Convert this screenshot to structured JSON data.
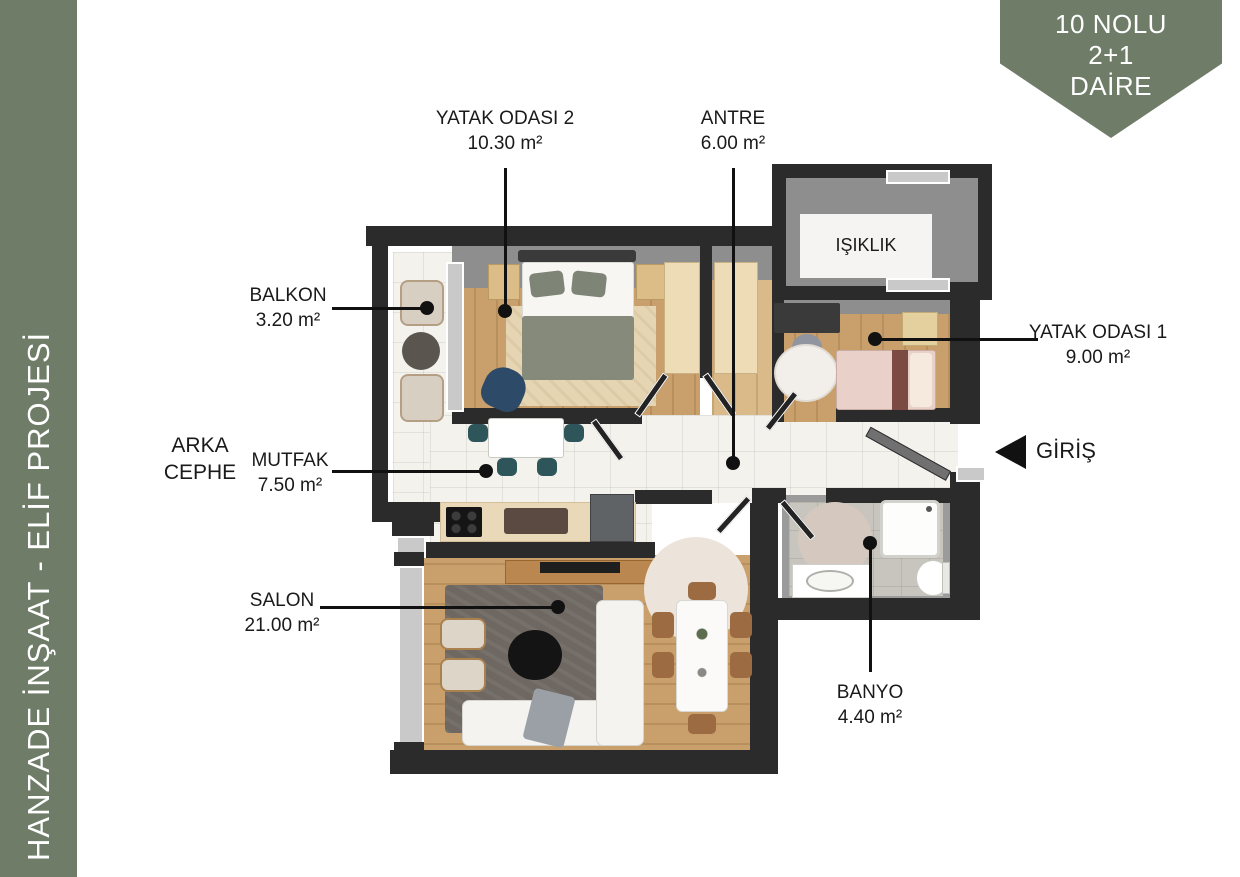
{
  "sidebar": {
    "text": "HANZADE İNŞAAT - ELİF PROJESİ"
  },
  "badge": {
    "line1": "10 NOLU",
    "line2": "2+1",
    "line3": "DAİRE"
  },
  "rooms": {
    "yatak_odasi_2": {
      "title": "YATAK ODASI 2",
      "area": "10.30 m²"
    },
    "antre": {
      "title": "ANTRE",
      "area": "6.00 m²"
    },
    "balkon": {
      "title": "BALKON",
      "area": "3.20 m²"
    },
    "mutfak": {
      "title": "MUTFAK",
      "area": "7.50 m²"
    },
    "salon": {
      "title": "SALON",
      "area": "21.00 m²"
    },
    "yatak_odasi_1": {
      "title": "YATAK ODASI 1",
      "area": "9.00 m²"
    },
    "banyo": {
      "title": "BANYO",
      "area": "4.40 m²"
    },
    "isiklik": {
      "title": "IŞIKLIK"
    },
    "giris": {
      "title": "GİRİŞ"
    }
  },
  "side_note": {
    "line1": "ARKA",
    "line2": "CEPHE"
  },
  "colors": {
    "accent_green": "#6F7D68",
    "wall_dark": "#2B2B2B",
    "wall_face_grey": "#8E8E8E",
    "wood_floor": "#C9A06C",
    "white_tile": "#F4F2ED",
    "bath_tile": "#C8C4BE",
    "label_text": "#1A1A1A"
  }
}
